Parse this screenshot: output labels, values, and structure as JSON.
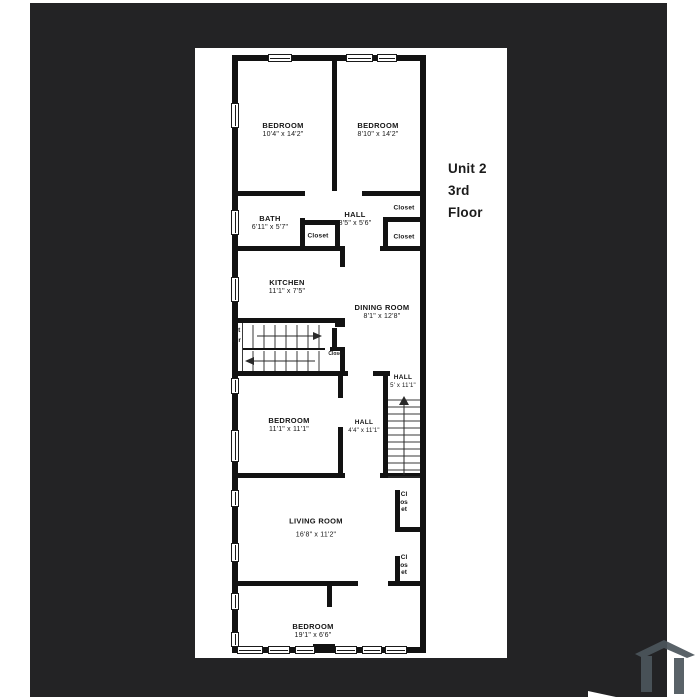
{
  "photo": {
    "background": "#232325",
    "watermark_icon": "house-logo-icon",
    "watermark_color": "#4c555c"
  },
  "plan": {
    "unit": {
      "line1": "Unit 2",
      "line2": "3rd Floor"
    },
    "rooms": {
      "bedroom_top_left": {
        "name": "BEDROOM",
        "dims": "10'4\" x 14'2\""
      },
      "bedroom_top_right": {
        "name": "BEDROOM",
        "dims": "8'10\" x 14'2\""
      },
      "bath": {
        "name": "BATH",
        "dims": "6'11\" x 5'7\""
      },
      "hall_top": {
        "name": "HALL",
        "dims": "8'5\" x 5'6\""
      },
      "kitchen": {
        "name": "KITCHEN",
        "dims": "11'1\" x 7'5\""
      },
      "dining_room": {
        "name": "DINING ROOM",
        "dims": "8'1\" x 12'8\""
      },
      "bedroom_middle": {
        "name": "BEDROOM",
        "dims": "11'1\" x 11'1\""
      },
      "hall_middle": {
        "name": "HALL",
        "dims": "4'4\" x 11'1\""
      },
      "hall_stairs": {
        "name": "HALL",
        "dims": "5' x 11'1\""
      },
      "living_room": {
        "name": "LIVING ROOM",
        "dims": "16'8\" x 11'2\""
      },
      "bedroom_bottom": {
        "name": "BEDROOM",
        "dims": "19'1\" x 6'6\""
      }
    },
    "closets": {
      "hall": "Closet",
      "right_upper": "Closet",
      "right_lower": "Closet",
      "stair": "Closet",
      "living_upper": "Closet",
      "living_lower": "Closet"
    },
    "labels": {
      "stair": "Stair"
    },
    "icons": {
      "stairs_up_arrow": "up-arrow-icon",
      "stairs_right_arrow": "right-arrow-icon",
      "stairs_left_arrow": "left-arrow-icon"
    }
  }
}
